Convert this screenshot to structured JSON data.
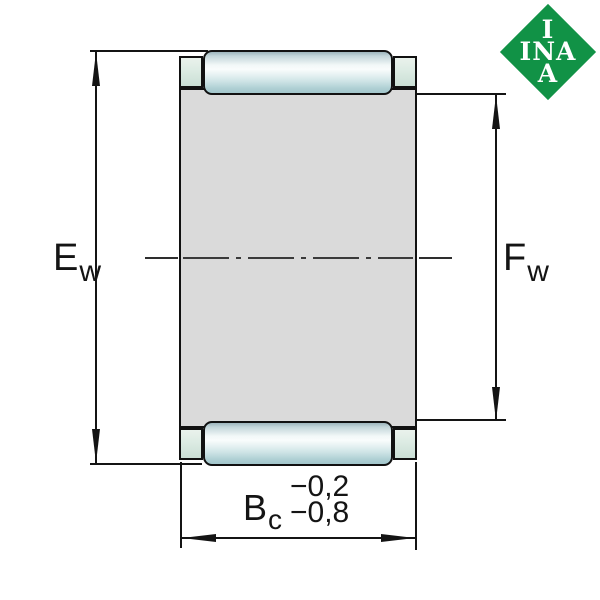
{
  "drawing": {
    "type": "bearing-cross-section",
    "subject": "needle roller and cage assembly",
    "dimensions": {
      "left": {
        "symbol": "E",
        "subscript": "w"
      },
      "right": {
        "symbol": "F",
        "subscript": "w"
      },
      "bottom": {
        "symbol": "B",
        "subscript": "c",
        "tolerance_upper": "−0,2",
        "tolerance_lower": "−0,8"
      }
    },
    "logo": {
      "line1": "I",
      "line2": "INA",
      "line3": "A",
      "color": "#119246"
    },
    "colors": {
      "cage_body": "#dadada",
      "cage_lip": "#dcebe3",
      "roller_highlight": "#f9fcfc",
      "roller_shade": "#a2c6cb",
      "outline": "#111111",
      "dimension_lines": "#141414",
      "background": "#ffffff"
    }
  }
}
